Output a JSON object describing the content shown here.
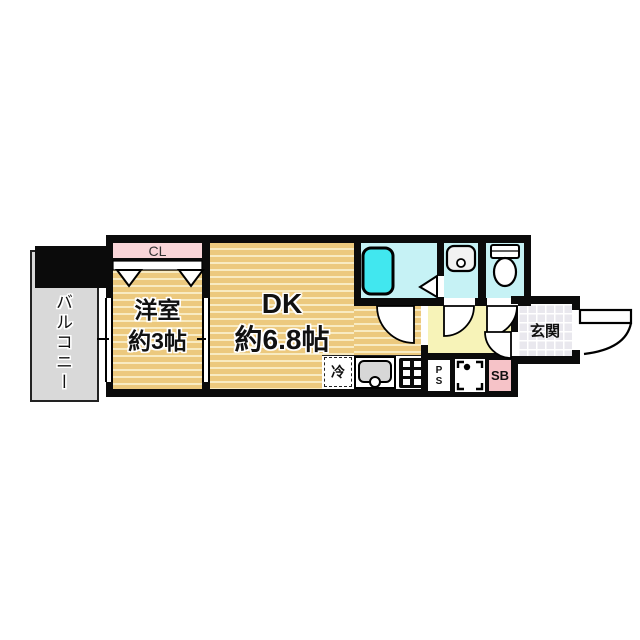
{
  "rooms": {
    "balcony": {
      "label": "バルコニー"
    },
    "closet": {
      "label": "CL"
    },
    "western_room": {
      "name": "洋室",
      "size": "約3帖"
    },
    "dining_kitchen": {
      "name": "DK",
      "size": "約6.8帖"
    },
    "entrance": {
      "label": "玄関"
    }
  },
  "fixtures": {
    "refrigerator": {
      "label": "冷"
    },
    "pipe_space": {
      "label_top": "P",
      "label_bottom": "S"
    },
    "shoe_box": {
      "label": "SB"
    }
  },
  "colors": {
    "wall_black": "#0b0b0b",
    "floor_tan": "#ecc97e",
    "floor_stripe_light": "#f8ebc2",
    "wet_area_cyan": "#c6f2f5",
    "bathtub_cyan": "#41e7ef",
    "hallway_yellow": "#f7f3b8",
    "closet_pink": "#f9d5d8",
    "shoebox_pink": "#f6c3c8",
    "balcony_gray": "#d9d9d9",
    "entrance_tile_gray": "#e9e8ee"
  }
}
